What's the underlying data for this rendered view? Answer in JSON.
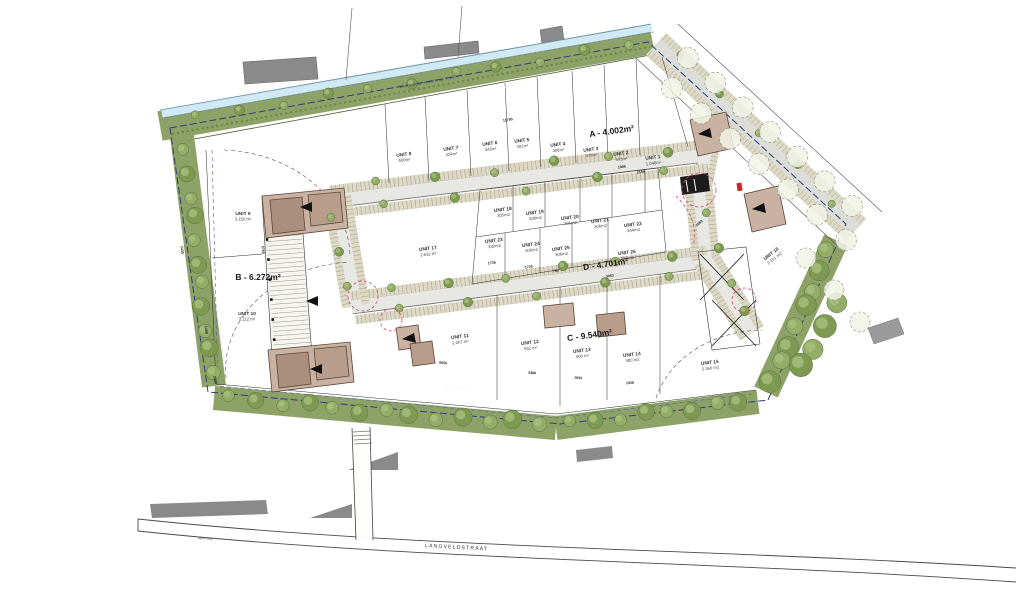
{
  "blocks": [
    {
      "id": "A",
      "label": "A - 4.002m²"
    },
    {
      "id": "B",
      "label": "B - 6.272m²"
    },
    {
      "id": "C",
      "label": "C - 9.540m²"
    },
    {
      "id": "D",
      "label": "D - 4.701m²"
    }
  ],
  "units": [
    {
      "name": "UNIT 1",
      "area": "1.048m²"
    },
    {
      "name": "UNIT 2",
      "area": "543m²"
    },
    {
      "name": "UNIT 3",
      "area": "478m²"
    },
    {
      "name": "UNIT 4",
      "area": "408m²"
    },
    {
      "name": "UNIT 5",
      "area": "392m²"
    },
    {
      "name": "UNIT 6",
      "area": "343m²"
    },
    {
      "name": "UNIT 7",
      "area": "324m²"
    },
    {
      "name": "UNIT 8",
      "area": "500m²"
    },
    {
      "name": "UNIT 9",
      "area": "3.150 m²"
    },
    {
      "name": "UNIT 10",
      "area": "3.112 m²"
    },
    {
      "name": "UNIT 11",
      "area": "2.267 m²"
    },
    {
      "name": "UNIT 12",
      "area": "932 m²"
    },
    {
      "name": "UNIT 13",
      "area": "900 m²"
    },
    {
      "name": "UNIT 14",
      "area": "900 m2"
    },
    {
      "name": "UNIT 15",
      "area": "2.360 m2"
    },
    {
      "name": "UNIT 16",
      "area": "2.151 m2"
    },
    {
      "name": "UNIT 17",
      "area": "1.632 m²"
    },
    {
      "name": "UNIT 18",
      "area": "305m2"
    },
    {
      "name": "UNIT 19",
      "area": "306m2"
    },
    {
      "name": "UNIT 20",
      "area": "306m2"
    },
    {
      "name": "UNIT 21",
      "area": "306m2"
    },
    {
      "name": "UNIT 22",
      "area": "344m2"
    },
    {
      "name": "UNIT 23",
      "area": "330m2"
    },
    {
      "name": "UNIT 24",
      "area": "306m2"
    },
    {
      "name": "UNIT 25",
      "area": "306m2"
    },
    {
      "name": "UNIT 26",
      "area": "559m2"
    }
  ],
  "labels": {
    "street": "LANGVELDSTRAAT",
    "street_surface": "asfalt weg",
    "waterway": "bestaande waterloop 7.16",
    "green_zone": "groenbuffer",
    "green_zone2": "groenbuffer"
  },
  "dimensions": [
    "11785",
    "1985",
    "2159",
    "1735",
    "1720",
    "750",
    "3053",
    "6050",
    "2480",
    "1930",
    "1935",
    "2430",
    "1490",
    "5760",
    "2659",
    "3430"
  ],
  "colors": {
    "green": "#8ea268",
    "road": "#e7e7e3",
    "parking": "#ded9c4",
    "building": "#c9b2a2",
    "boundary": "#2b3d7a",
    "water": "#cfe9f5",
    "accent_red": "#d4446a"
  }
}
